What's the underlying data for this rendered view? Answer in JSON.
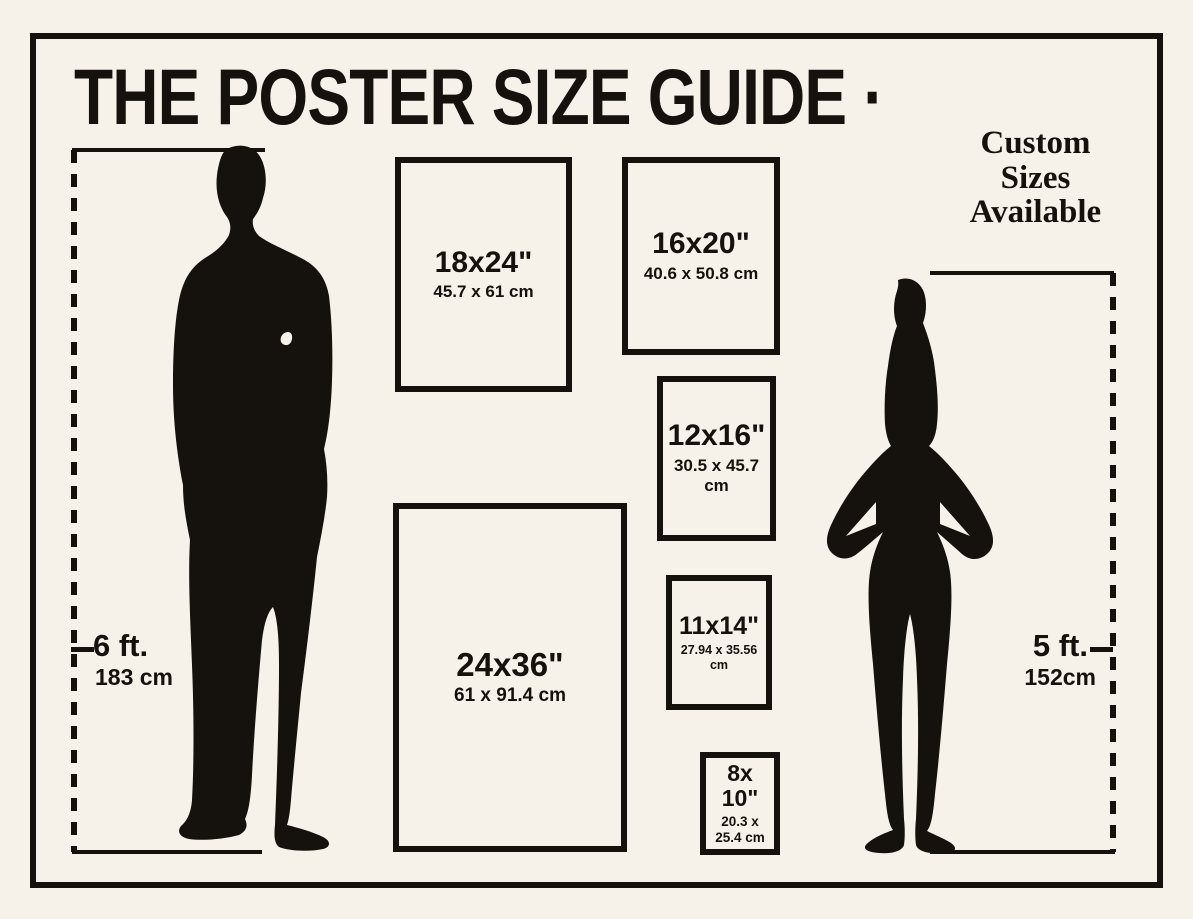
{
  "colors": {
    "background": "#f7f2e9",
    "ink": "#15110d"
  },
  "title": "THE POSTER SIZE GUIDE ·",
  "custom_note": "Custom\nSizes\nAvailable",
  "left_figure": {
    "icon": "man-silhouette",
    "height_imperial": "6 ft.",
    "height_metric": "183 cm"
  },
  "right_figure": {
    "icon": "woman-silhouette",
    "height_imperial": "5 ft.",
    "height_metric": "152cm"
  },
  "posters": [
    {
      "size": "18x24\"",
      "metric": "45.7 x 61 cm"
    },
    {
      "size": "16x20\"",
      "metric": "40.6 x 50.8 cm"
    },
    {
      "size": "12x16\"",
      "metric": "30.5 x 45.7 cm"
    },
    {
      "size": "24x36\"",
      "metric": "61 x 91.4 cm"
    },
    {
      "size": "11x14\"",
      "metric": "27.94 x 35.56 cm"
    },
    {
      "size": "8x\n10\"",
      "metric": "20.3 x\n25.4 cm"
    }
  ]
}
